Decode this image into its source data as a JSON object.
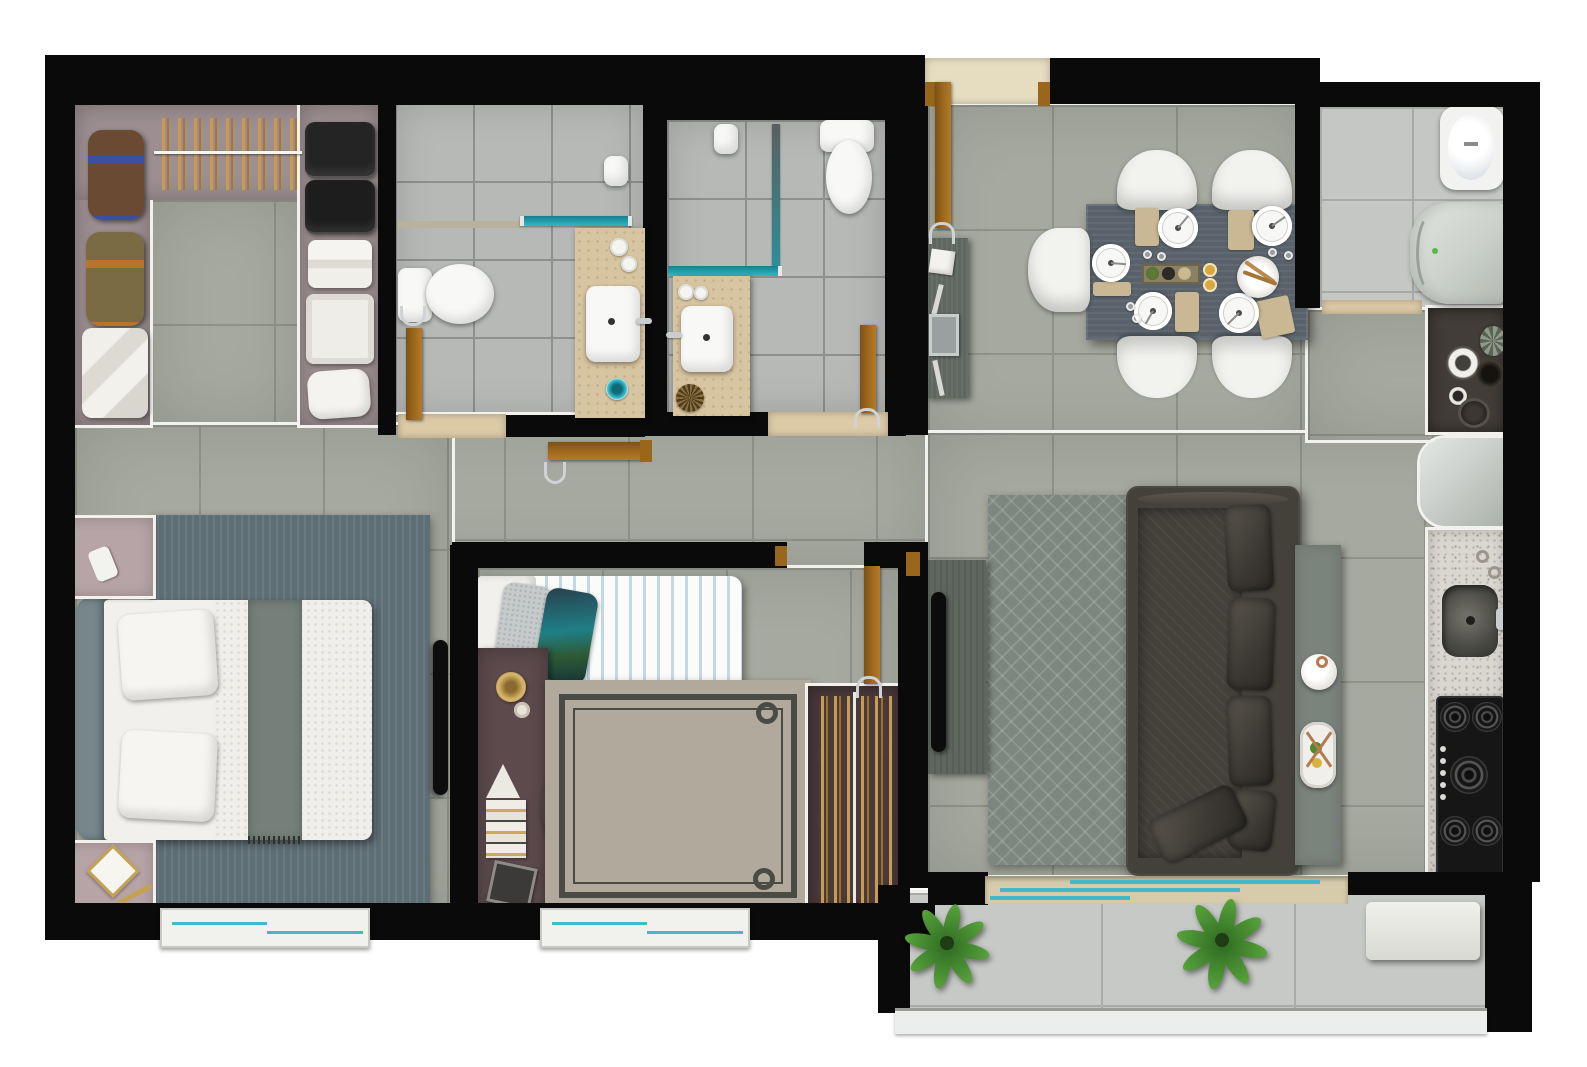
{
  "meta": {
    "kind": "3d-rendered-apartment-floor-plan-top-view",
    "visible_text_present": false,
    "visible_text": []
  },
  "palette": {
    "wall": "#0a0a0a",
    "trim": "#f2f1ed",
    "floor_main": "#a6a99f",
    "grout_main": "#8f9287",
    "floor_bath": "#b6b9b5",
    "grout_bath": "#8d908c",
    "floor_service": "#c4c7c3",
    "floor_balcony": "#c6c9c5",
    "mauve": "#9c8e91",
    "mauve_light": "#b7a4a7",
    "beige": "#d7c4a0",
    "threshold": "#ddcaa7",
    "door": "#9a661c",
    "teal_glass": "#35b8c6",
    "window_blue": "#41b9c9",
    "sofa": "#44413a",
    "rug_living": "#7d8780",
    "rug_master": "#5e6e75",
    "rug_bed2": "#b1a99b",
    "desk": "#5c4a4d",
    "wardrobe": "#4a3a3c",
    "clothes_tan": "#c89b52",
    "table": "#59626b",
    "console": "#5e665f",
    "granite": "#dad7d0",
    "counter_dark": "#423d38",
    "stove": "#161616",
    "fridge": "#c9cdc9",
    "chair_brown": "#5c4026",
    "plant_dark": "#2f6b22",
    "plant_light": "#57a33b",
    "placemat": "#c9b893"
  },
  "rooms": [
    {
      "id": "walk-in-closet",
      "furniture": [
        "hanging-clothes-rail",
        "duffel-bag-brown",
        "duffel-bag-olive",
        "folded-linens",
        "garment-bags-black",
        "towel-stack",
        "storage-basket",
        "small-pillow"
      ]
    },
    {
      "id": "bathroom-1",
      "furniture": [
        "shower-glass-partition",
        "shampoo-bottle",
        "toilet",
        "vanity-counter",
        "sink",
        "faucet",
        "soap-dishes",
        "door",
        "threshold"
      ]
    },
    {
      "id": "bathroom-2",
      "furniture": [
        "corner-shower-glass",
        "shampoo-bottle",
        "toilet",
        "vanity-counter",
        "sink",
        "faucet",
        "soap-dishes",
        "door",
        "threshold"
      ]
    },
    {
      "id": "hallway",
      "furniture": [
        "master-suite-door",
        "bedroom-2-door"
      ]
    },
    {
      "id": "master-bedroom",
      "furniture": [
        "double-bed",
        "headboard",
        "pillows",
        "gray-throw",
        "area-rug",
        "nightstand-top",
        "nightstand-bottom",
        "wall-tv",
        "window"
      ]
    },
    {
      "id": "bedroom-2",
      "furniture": [
        "single-bed-striped",
        "gray-pillow",
        "teal-pillow",
        "desk",
        "desk-lamp-disc",
        "books",
        "magazine",
        "chair",
        "area-rug-with-border",
        "wardrobe-with-clothes",
        "window"
      ]
    },
    {
      "id": "dining-area",
      "furniture": [
        "entry-door",
        "doormat",
        "sideboard",
        "dining-table",
        "dining-chairs-x5",
        "plates-x5",
        "placemats",
        "table-runner",
        "bowls",
        "glasses"
      ]
    },
    {
      "id": "living-room",
      "furniture": [
        "sofa-3-seat",
        "back-cushions-x4",
        "throw-pillow",
        "area-rug-diamond",
        "tv-console",
        "tv",
        "side-table",
        "vase",
        "tray"
      ]
    },
    {
      "id": "kitchen",
      "furniture": [
        "counter-with-decor",
        "refrigerator",
        "granite-counter",
        "sink",
        "faucet",
        "gas-cooktop-5-burners"
      ]
    },
    {
      "id": "service-area",
      "furniture": [
        "water-heater",
        "washing-machine",
        "threshold"
      ]
    },
    {
      "id": "balcony",
      "furniture": [
        "sliding-glass-door",
        "potted-plant-left",
        "potted-plant-right",
        "bench",
        "railing"
      ]
    }
  ]
}
